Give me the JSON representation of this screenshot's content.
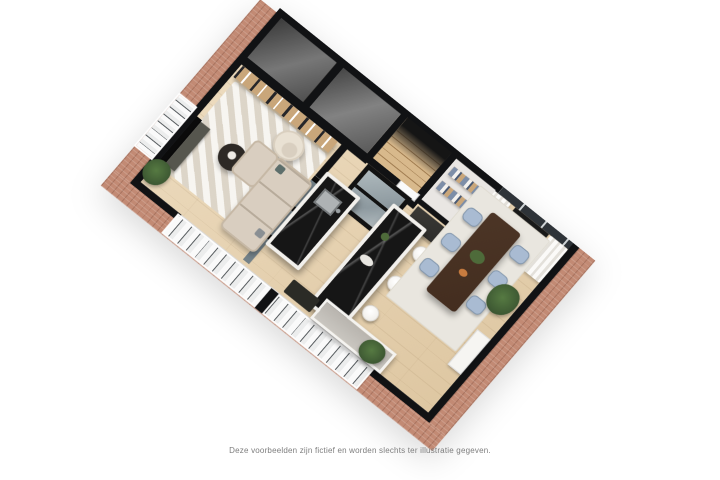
{
  "caption": {
    "text": "Deze voorbeelden zijn fictief en worden slechts ter illustratie gegeven."
  },
  "scene": {
    "type": "3d-floorplan-cutaway-render",
    "view": "axonometric, plan rotated ~45 degrees on white background",
    "rooms": [
      "living-room (TV wall, wall shelf with books, beige L-sofa, cream armchair, round coffee table, striped rug, plants)",
      "open-kitchen (two black-marble islands, one with sink and faucet, bar island with three white stools, grey-top perimeter counter, dark tall cabinets)",
      "dining-area (dark wood table, six light-blue chairs, cream rug, tall plant, window with white curtains and radiator, white console against brick wall)",
      "hallway-with-staircase (wooden stairs ascending to dark upper landing, white interior door)",
      "storage-room (shelves with folded linens)",
      "utility-room (glass-topped)",
      "adjacent-dark-rooms (two unlit grey rooms at top, cut open)"
    ],
    "exterior": "cut brick walls with black section tops; large white-framed window walls on lower-left facade and left facade"
  },
  "colors": {
    "wall": "#111214",
    "brick": "#c28a74",
    "floor_a": "#eeddc1",
    "floor_b": "#dec7a2",
    "marble": "#161616",
    "sofa": "#d9cec0",
    "chair_blue": "#a9bbd2",
    "rug_living": "#ece6db",
    "rug_dining": "#e9e6df",
    "wood_shelf": "#c9a67a",
    "plant": "#3b5531",
    "table_wood": "#432d1f",
    "stool": "#f2f0ec",
    "caption": "#7d7d7d",
    "background": "#ffffff"
  }
}
